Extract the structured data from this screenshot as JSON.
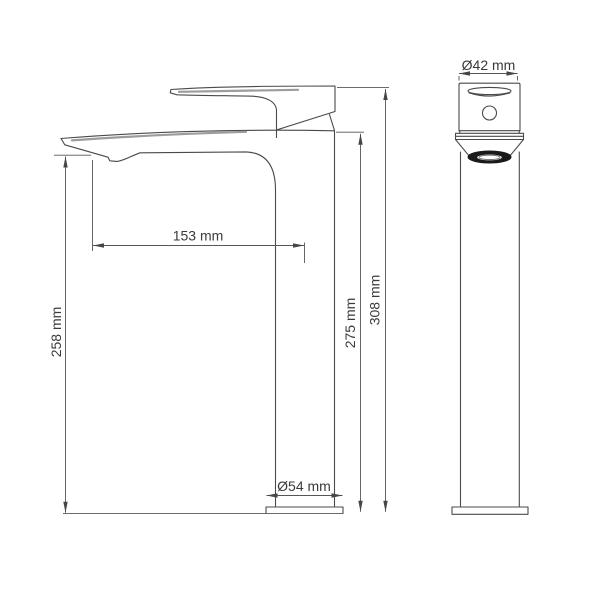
{
  "dimensions": {
    "spout_reach": {
      "label": "153 mm",
      "orientation": "horizontal"
    },
    "spout_outlet_height": {
      "label": "258 mm",
      "orientation": "vertical"
    },
    "spout_top_height": {
      "label": "275 mm",
      "orientation": "vertical"
    },
    "overall_height": {
      "label": "308 mm",
      "orientation": "vertical"
    },
    "body_diameter": {
      "label": "Ø42 mm",
      "orientation": "horizontal"
    },
    "base_diameter": {
      "label": "Ø54 mm",
      "orientation": "horizontal"
    }
  },
  "style": {
    "background": "#ffffff",
    "outline_color": "#4a4a4a",
    "dimension_line_color": "#565656",
    "accent_line_color": "#9c9c9c",
    "text_color": "#3a3a3a",
    "aerator_fill": "#1a1a1a"
  }
}
